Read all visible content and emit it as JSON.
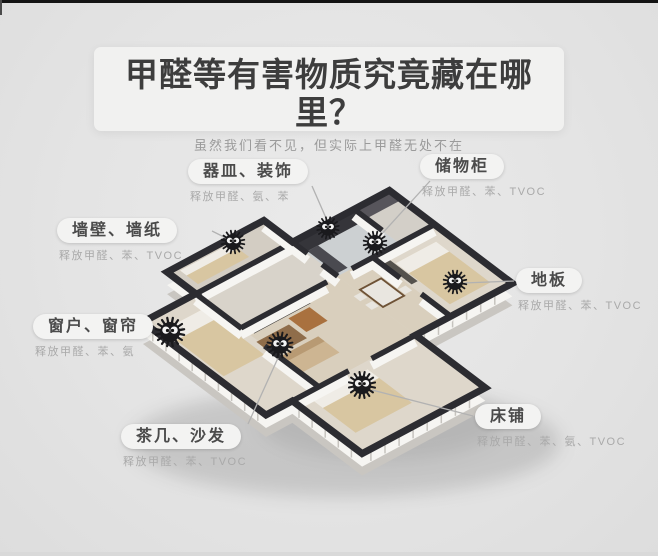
{
  "page": {
    "title": "甲醛等有害物质究竟藏在哪里？",
    "subtitle": "虽然我们看不见，但实际上甲醛无处不在"
  },
  "labels": [
    {
      "id": "vessels",
      "title": "器皿、装饰",
      "detail": "释放甲醛、氨、苯",
      "icon": "soot-sprite-icon"
    },
    {
      "id": "storage",
      "title": "储物柜",
      "detail": "释放甲醛、苯、TVOC",
      "icon": "soot-sprite-icon"
    },
    {
      "id": "wall",
      "title": "墙壁、墙纸",
      "detail": "释放甲醛、苯、TVOC",
      "icon": "soot-sprite-icon"
    },
    {
      "id": "floor",
      "title": "地板",
      "detail": "释放甲醛、苯、TVOC",
      "icon": "soot-sprite-icon"
    },
    {
      "id": "window",
      "title": "窗户、窗帘",
      "detail": "释放甲醛、苯、氨",
      "icon": "soot-sprite-icon"
    },
    {
      "id": "bed",
      "title": "床铺",
      "detail": "释放甲醛、苯、氨、TVOC",
      "icon": "soot-sprite-icon"
    },
    {
      "id": "sofa",
      "title": "茶几、沙发",
      "detail": "释放甲醛、苯、TVOC",
      "icon": "soot-sprite-icon"
    }
  ],
  "colors": {
    "background": "#e4e4e4",
    "top_bar": "#141414",
    "panel": "#f1f1f0",
    "title_text": "#3d3d3d",
    "subtitle_text": "#9b9b9b",
    "pill_bg": "#f3f3f2",
    "pill_text": "#4b4b4b",
    "detail_text": "#a9a9a9",
    "wall_dark": "#2c2c31",
    "wall_face": "#f6f5f2",
    "floor_warm": "#d9cfbd",
    "bed_tan": "#d8c6a1",
    "connector": "#b2b2b2",
    "sprite": "#1a1a1d"
  }
}
